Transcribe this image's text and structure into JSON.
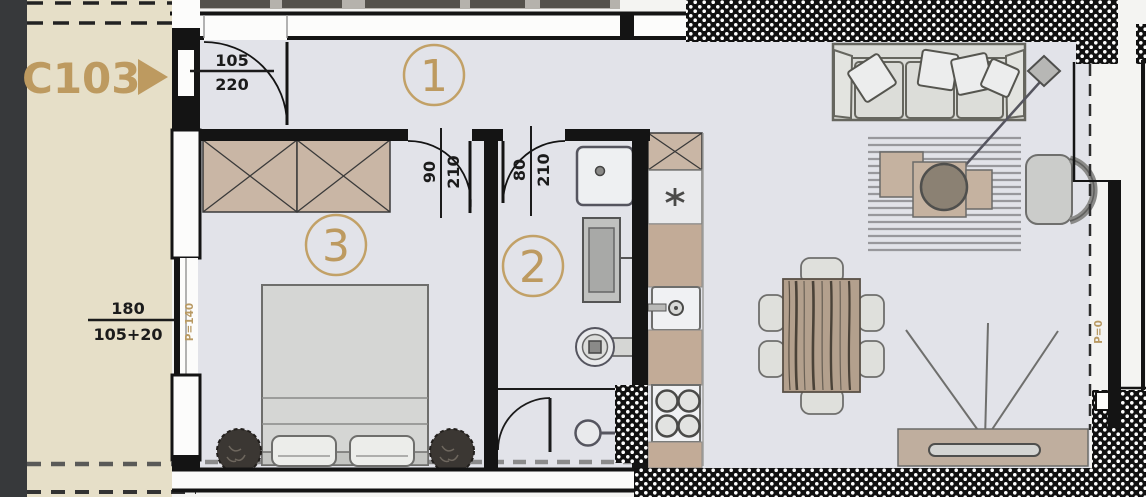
{
  "floor_plan": {
    "corridor": {
      "unit_label": "C103",
      "arrow_icon": "triangle-right",
      "window": {
        "width": "180",
        "height": "105+20",
        "parapet": "P=140"
      }
    },
    "rooms": [
      {
        "number": "1"
      },
      {
        "number": "2"
      },
      {
        "number": "3"
      }
    ],
    "doors": {
      "entrance": {
        "width": "105",
        "height": "220"
      },
      "room3": {
        "width": "90",
        "height": "210"
      },
      "room2": {
        "width": "80",
        "height": "210"
      }
    },
    "terrace": {
      "parapet": "P=0"
    },
    "colors": {
      "accent_tan": "#bd9a60",
      "floor": "#e2e3e9",
      "corridor_floor": "#e6dfc8",
      "furniture_tan": "#c9b6a5",
      "wall_black": "#141414",
      "outside": "#37393b"
    }
  }
}
